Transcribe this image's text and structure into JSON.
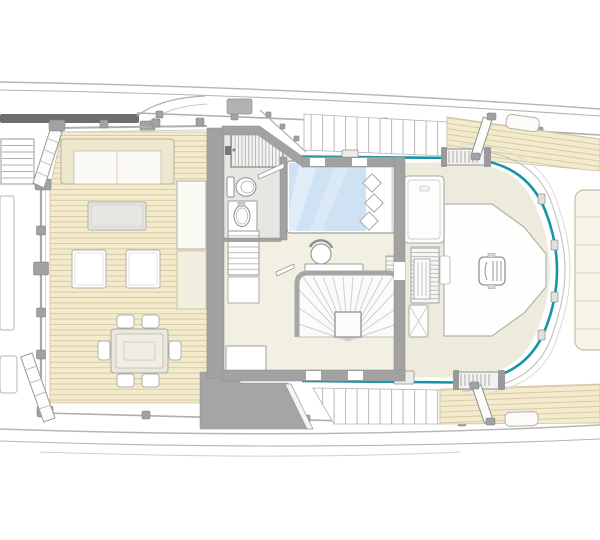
{
  "meta": {
    "title": "Yacht main deck floor plan (top view, bow to the right)",
    "type": "architectural-floor-plan",
    "visible_text": "none"
  },
  "palette": {
    "background": "#ffffff",
    "hull_line": "#b5b5b5",
    "rail_gray": "#aeaeae",
    "rail_teal": "#1495a5",
    "teak": "#f3ebcb",
    "teak_line": "#cfc3a0",
    "interior_floor": "#f1f0e3",
    "terrace": "#edecdc",
    "marble": "#e8e6e2",
    "wall": "#a2a2a2",
    "wall_dark": "#8a8a8a",
    "outline": "#b0b0b0",
    "furniture_white": "#ffffff",
    "furniture_gray": "#e6e6e3",
    "stanchion": "#a2a2a2",
    "bed": "#cfe2f4",
    "shadow_bar": "#6e6e6e"
  },
  "features": {
    "aft_deck": [
      "boarding-stairs",
      "gangway-steps",
      "sofa",
      "coffee-table",
      "ottomans",
      "sideboard-cabinets",
      "dining-table",
      "dining-chairs-x6",
      "teak-planking",
      "guard-rail"
    ],
    "owner_cabin": [
      "shower",
      "toilet",
      "washbasin",
      "shelf-unit",
      "double-bed",
      "pillows",
      "vanity-desk",
      "stool",
      "wardrobe-slats",
      "curved-staircase",
      "bench"
    ],
    "foredeck": [
      "terrace-platform",
      "deck-hatch",
      "forward-bench",
      "slatted-locker",
      "bow-sunpad",
      "teal-safety-rail",
      "boarding-gates",
      "side-deck-steps",
      "deck-hatches"
    ]
  }
}
